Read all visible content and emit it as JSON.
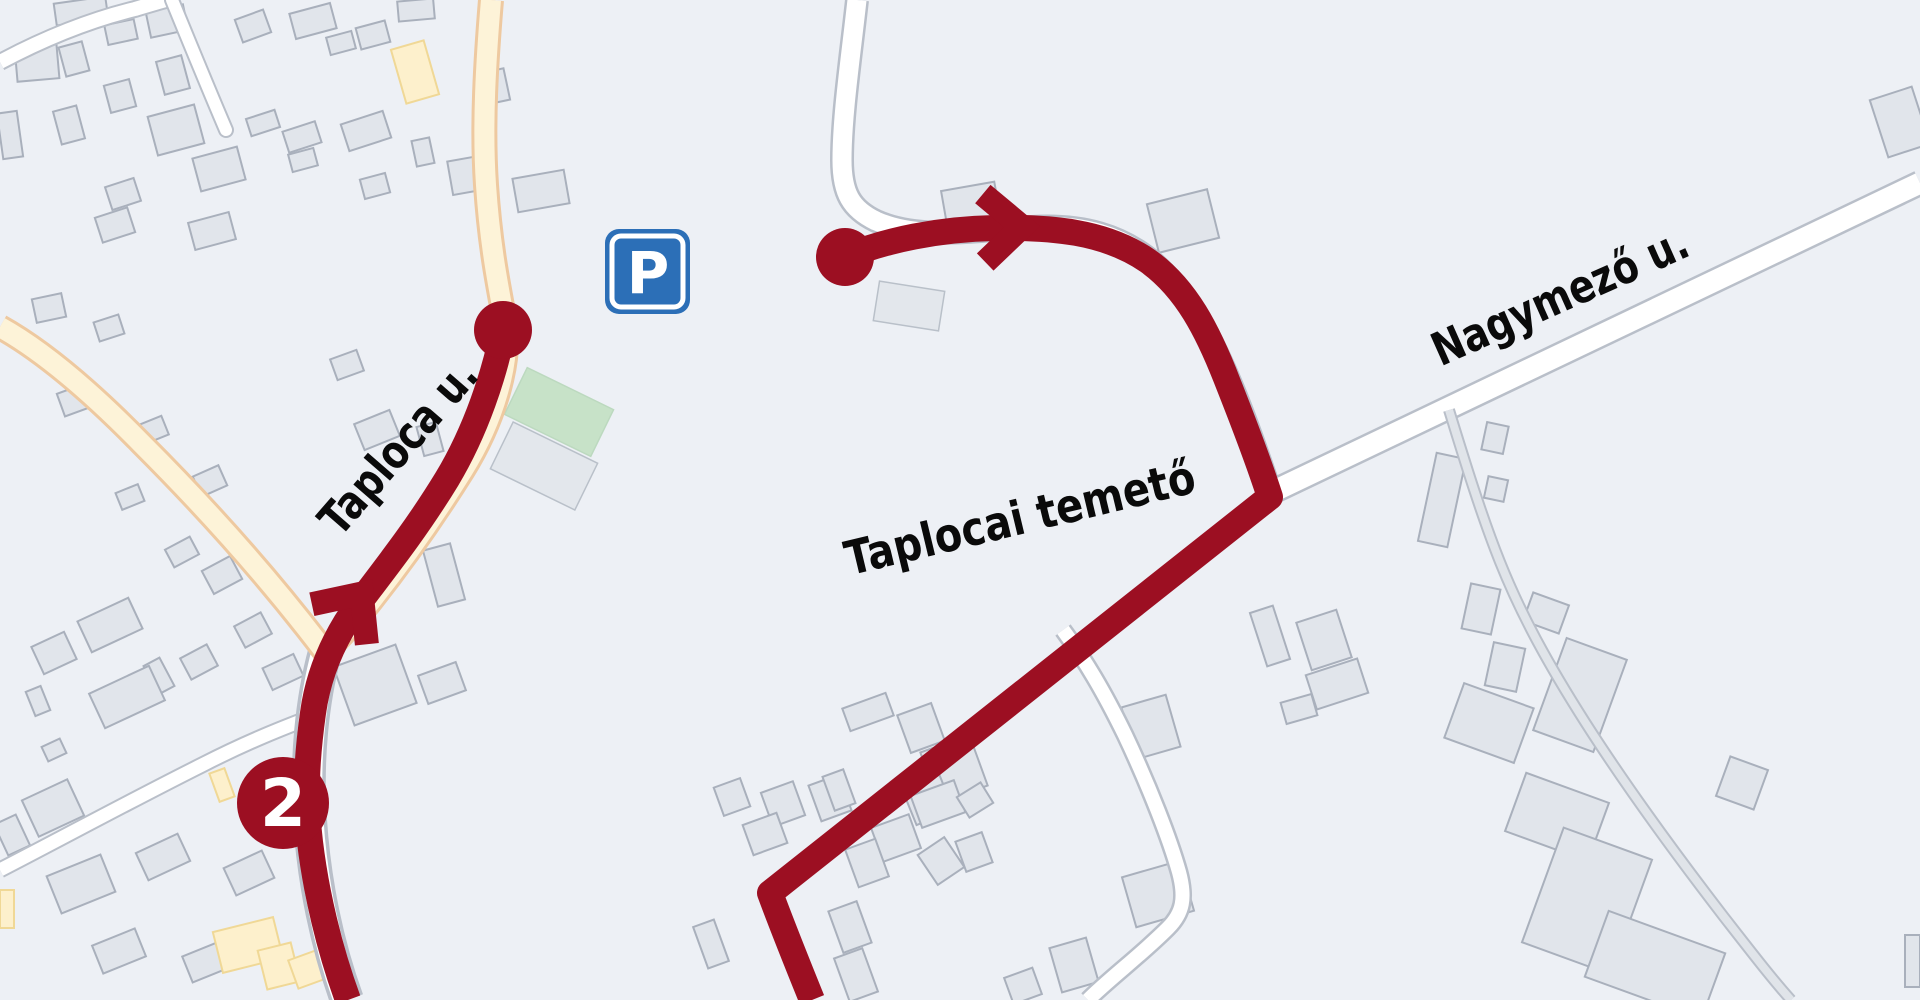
{
  "map": {
    "labels": {
      "street_taploca": "Taploca u.",
      "street_nagymezo": "Nagymező u.",
      "cemetery": "Taplocai temető"
    },
    "route": {
      "badge_number": "2"
    },
    "parking": {
      "glyph": "P"
    },
    "colors": {
      "background": "#edf0f5",
      "route_red": "#9c0f22",
      "cemetery_green": "#9dd2a6",
      "road_yellow": "#fdf3d8",
      "road_yellow_casing": "#eec9a0",
      "road_white": "#ffffff",
      "road_casing": "#b9bfc9",
      "building_fill": "#e1e5eb",
      "building_stroke": "#a9b0bc",
      "building_yellow_fill": "#fdf0cc",
      "building_pale_green_fill": "#c7e2c8",
      "parking_blue": "#2c6fb7",
      "label_color": "#0a0a0a"
    }
  }
}
